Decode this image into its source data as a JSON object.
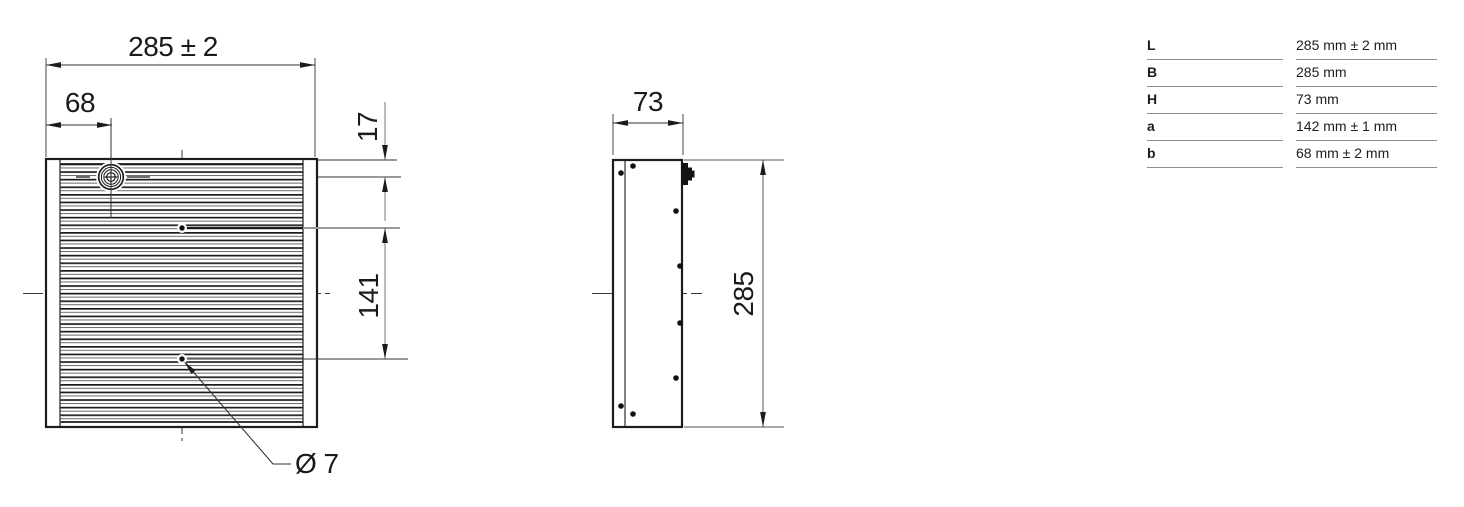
{
  "drawing": {
    "front_view": {
      "dim_width_label": "285 ± 2",
      "dim_offset_label": "68",
      "dim_screw_top_label": "17",
      "dim_hole_spacing_label": "141",
      "hole_diameter_label": "Ø 7"
    },
    "side_view": {
      "dim_depth_label": "73",
      "dim_height_label": "285"
    }
  },
  "spec_table": {
    "rows": [
      {
        "key": "L",
        "value": "285 mm ± 2 mm"
      },
      {
        "key": "B",
        "value": "285 mm"
      },
      {
        "key": "H",
        "value": "73 mm"
      },
      {
        "key": "a",
        "value": "142 mm ± 1 mm"
      },
      {
        "key": "b",
        "value": "68 mm ± 2 mm"
      }
    ]
  },
  "colors": {
    "line": "#1c1c1c",
    "fin_thin": "#5a5a5a",
    "gray_extension": "#9a9a9a",
    "table_border": "#8e8e8e",
    "text": "#1d1d1d",
    "background": "#ffffff"
  }
}
